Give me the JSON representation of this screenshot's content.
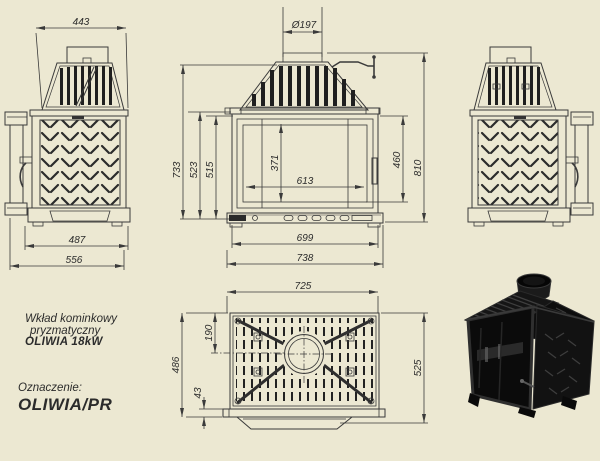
{
  "title_block": {
    "line1": "Wkład kominkowy",
    "line2": "pryzmatyczny",
    "line3": "OLIWIA 18kW",
    "designation_label": "Oznaczenie:",
    "designation_value": "OLIWIA/PR"
  },
  "dims": {
    "side_left_view": {
      "top_width": "443",
      "base_depth": "487",
      "total_depth": "556"
    },
    "front_view": {
      "flue_diameter": "Ø197",
      "height_outer": "733",
      "height_mid": "523",
      "height_inner": "515",
      "glass_height": "371",
      "glass_width": "613",
      "door_height": "460",
      "total_height": "810",
      "width_inner": "699",
      "width_total": "738"
    },
    "top_view": {
      "width": "725",
      "flue_center_offset": "190",
      "body_depth": "486",
      "front_lip": "43",
      "total_depth": "525"
    }
  },
  "colors": {
    "background": "#ece8d2",
    "line": "#3a3a3a",
    "ink": "#2b2b2b",
    "render_black": "#111111"
  }
}
